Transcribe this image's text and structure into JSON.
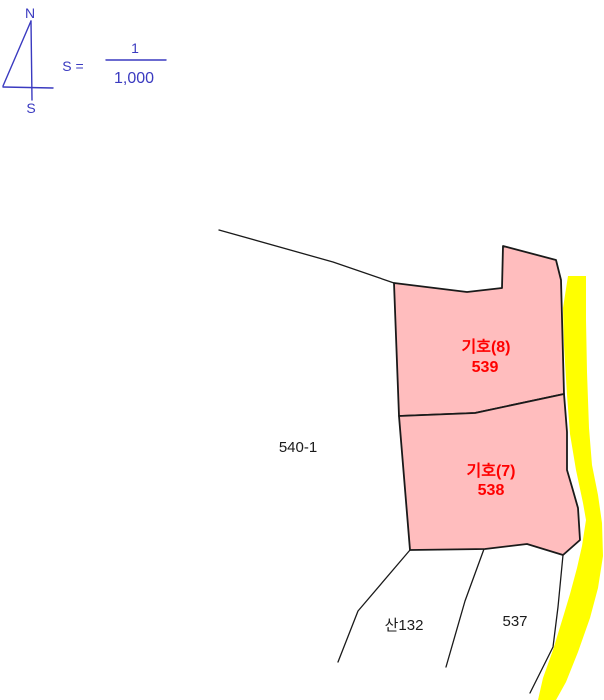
{
  "colors": {
    "blue": "#3a3ac0",
    "red": "#ff0000",
    "parcel_fill": "#ffbdbe",
    "road_yellow": "#ffff00",
    "boundary": "#1a1a1a"
  },
  "compass": {
    "north": "N",
    "south": "S"
  },
  "scale": {
    "label": "S =",
    "numerator": "1",
    "denominator": "1,000"
  },
  "parcels": {
    "highlighted": [
      {
        "designation": "기호(8)",
        "number": "539"
      },
      {
        "designation": "기호(7)",
        "number": "538"
      }
    ],
    "adjacent": [
      {
        "number": "540-1"
      },
      {
        "number": "산132"
      },
      {
        "number": "537"
      }
    ]
  }
}
